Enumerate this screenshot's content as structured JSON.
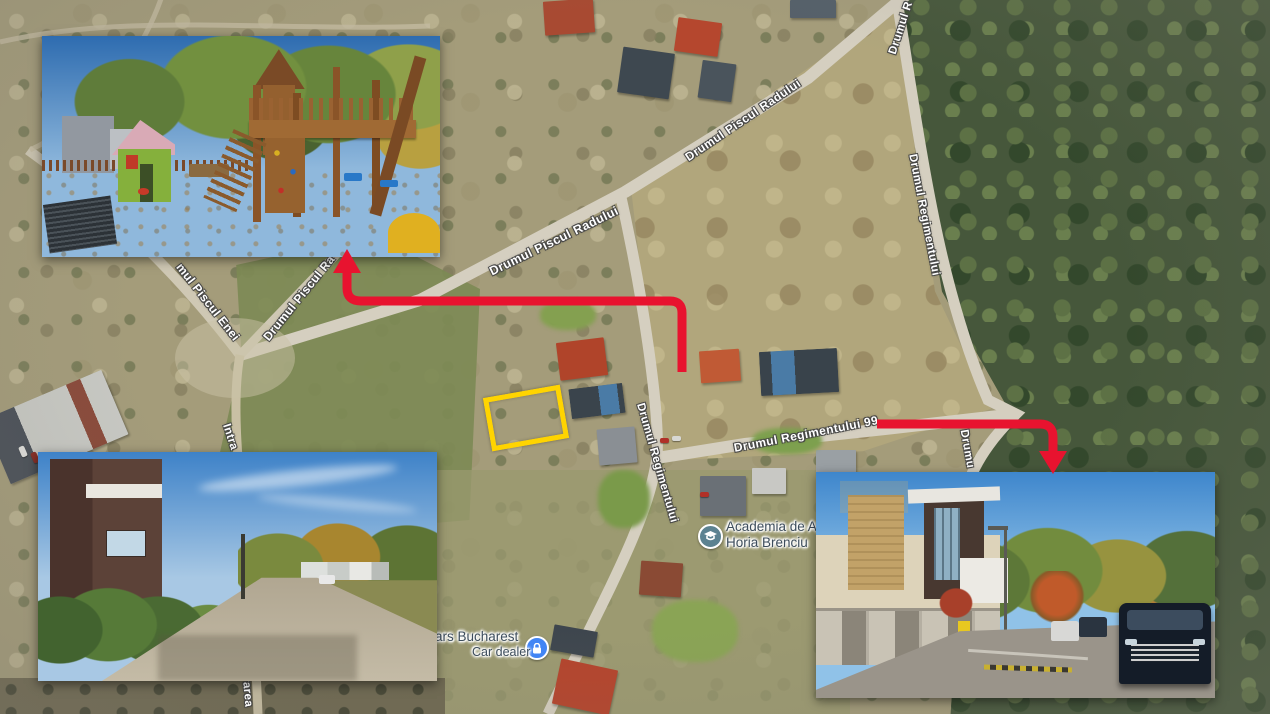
{
  "map": {
    "type": "satellite",
    "street_labels": [
      {
        "id": "piscul_radului_a",
        "text": "Drumul Piscul Radului"
      },
      {
        "id": "piscul_radului_b",
        "text": "Drumul Piscul Radului"
      },
      {
        "id": "piscul_radului_c",
        "text": "Drumul Piscul Ra"
      },
      {
        "id": "piscul_enei",
        "text": "mul Piscul Enei"
      },
      {
        "id": "intrarea_a",
        "text": "Intra"
      },
      {
        "id": "intrarea_b",
        "text": "trarea"
      },
      {
        "id": "regimentului_center",
        "text": "Drumul Regimentului"
      },
      {
        "id": "regimentului_99",
        "text": "Drumul Regimentului 99"
      },
      {
        "id": "regimentului_right",
        "text": "Drumul Regimentului"
      },
      {
        "id": "regimentului_top",
        "text": "Drumul R"
      },
      {
        "id": "drumu_junction",
        "text": "Drumu"
      }
    ],
    "pois": [
      {
        "id": "academia",
        "line1": "Academia de A",
        "line2": "Horia Brenciu",
        "icon": "graduation-cap",
        "icon_color": "#5c8291"
      },
      {
        "id": "car_dealer",
        "line1": "ars Bucharest",
        "line2": "Car dealer",
        "icon": "lock",
        "icon_color": "#4285f4"
      }
    ]
  },
  "annotations": {
    "plot_outline_color": "#ffd400",
    "arrow_color": "#e8132f",
    "arrows": [
      {
        "id": "arrow-to-playground",
        "direction": "up"
      },
      {
        "id": "arrow-to-street-photo",
        "direction": "down"
      }
    ]
  },
  "photos": [
    {
      "id": "playground",
      "description": "playground with wooden climbing structure and green playhouse"
    },
    {
      "id": "street_west",
      "description": "gravel street with modern brown house"
    },
    {
      "id": "street_east",
      "description": "paved street with modern houses and dark SUV"
    }
  ]
}
